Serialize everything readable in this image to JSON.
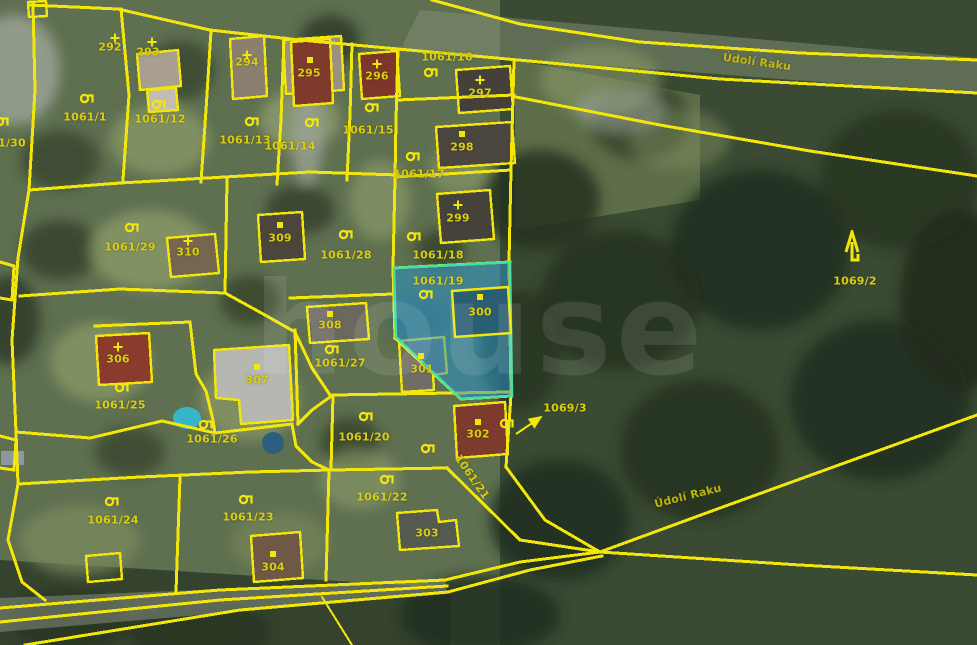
{
  "map": {
    "watermark": "house",
    "colors": {
      "boundary_line": "#f2e60a",
      "label_text": "#d9cd12",
      "highlight_fill": "rgba(40,150,205,0.52)",
      "highlight_stroke": "#44e0a8"
    },
    "highlighted_parcel": "1061/19",
    "road_labels": [
      {
        "t": "Údolí Raku",
        "x": 757,
        "y": 62,
        "rot": 8
      },
      {
        "t": "Údolí Raku",
        "x": 688,
        "y": 496,
        "rot": -14
      }
    ],
    "parcel_labels": [
      {
        "t": "292",
        "x": 110,
        "y": 47
      },
      {
        "t": "293",
        "x": 148,
        "y": 52
      },
      {
        "t": "294",
        "x": 247,
        "y": 62
      },
      {
        "t": "295",
        "x": 309,
        "y": 73
      },
      {
        "t": "296",
        "x": 377,
        "y": 76
      },
      {
        "t": "297",
        "x": 480,
        "y": 93
      },
      {
        "t": "298",
        "x": 462,
        "y": 147
      },
      {
        "t": "299",
        "x": 458,
        "y": 218
      },
      {
        "t": "300",
        "x": 480,
        "y": 312
      },
      {
        "t": "301",
        "x": 422,
        "y": 369
      },
      {
        "t": "302",
        "x": 478,
        "y": 434
      },
      {
        "t": "303",
        "x": 427,
        "y": 533
      },
      {
        "t": "304",
        "x": 273,
        "y": 567
      },
      {
        "t": "306",
        "x": 118,
        "y": 359
      },
      {
        "t": "307",
        "x": 257,
        "y": 380
      },
      {
        "t": "308",
        "x": 330,
        "y": 325
      },
      {
        "t": "309",
        "x": 280,
        "y": 238
      },
      {
        "t": "310",
        "x": 188,
        "y": 252
      },
      {
        "t": "1061/1",
        "x": 85,
        "y": 117
      },
      {
        "t": "1061/12",
        "x": 160,
        "y": 119
      },
      {
        "t": "1061/13",
        "x": 245,
        "y": 140
      },
      {
        "t": "1061/14",
        "x": 290,
        "y": 146
      },
      {
        "t": "1061/15",
        "x": 368,
        "y": 130
      },
      {
        "t": "1061/16",
        "x": 447,
        "y": 57
      },
      {
        "t": "1061/17",
        "x": 419,
        "y": 174
      },
      {
        "t": "1061/18",
        "x": 438,
        "y": 255
      },
      {
        "t": "1061/19",
        "x": 438,
        "y": 281
      },
      {
        "t": "1061/29",
        "x": 130,
        "y": 247
      },
      {
        "t": "1061/28",
        "x": 346,
        "y": 255
      },
      {
        "t": "1061/27",
        "x": 340,
        "y": 363
      },
      {
        "t": "1061/25",
        "x": 120,
        "y": 405
      },
      {
        "t": "1061/26",
        "x": 212,
        "y": 439
      },
      {
        "t": "1061/20",
        "x": 364,
        "y": 437
      },
      {
        "t": "1061/21",
        "x": 472,
        "y": 477,
        "rot": 55
      },
      {
        "t": "1061/22",
        "x": 382,
        "y": 497
      },
      {
        "t": "1061/23",
        "x": 248,
        "y": 517
      },
      {
        "t": "1061/24",
        "x": 113,
        "y": 520
      },
      {
        "t": "1069/2",
        "x": 855,
        "y": 281
      },
      {
        "t": "1069/3",
        "x": 565,
        "y": 408
      },
      {
        "t": "1/30",
        "x": 12,
        "y": 143
      }
    ],
    "symbols": {
      "landuse": [
        [
          88,
          99
        ],
        [
          160,
          105
        ],
        [
          253,
          122
        ],
        [
          313,
          123
        ],
        [
          373,
          108
        ],
        [
          432,
          73
        ],
        [
          414,
          157
        ],
        [
          415,
          237
        ],
        [
          427,
          295
        ],
        [
          133,
          228
        ],
        [
          347,
          235
        ],
        [
          333,
          350
        ],
        [
          123,
          388
        ],
        [
          207,
          425
        ],
        [
          367,
          417
        ],
        [
          429,
          449
        ],
        [
          388,
          480
        ],
        [
          113,
          502
        ],
        [
          247,
          500
        ],
        [
          508,
          424
        ],
        [
          3,
          122
        ]
      ],
      "cross": [
        [
          115,
          38
        ],
        [
          152,
          42
        ],
        [
          247,
          55
        ],
        [
          377,
          64
        ],
        [
          480,
          80
        ],
        [
          458,
          205
        ],
        [
          188,
          241
        ],
        [
          118,
          347
        ]
      ],
      "square": [
        [
          310,
          60
        ],
        [
          462,
          134
        ],
        [
          480,
          297
        ],
        [
          421,
          356
        ],
        [
          478,
          422
        ],
        [
          273,
          554
        ],
        [
          330,
          314
        ],
        [
          280,
          225
        ],
        [
          257,
          367
        ]
      ],
      "tree": [
        [
          853,
          247
        ]
      ]
    }
  }
}
